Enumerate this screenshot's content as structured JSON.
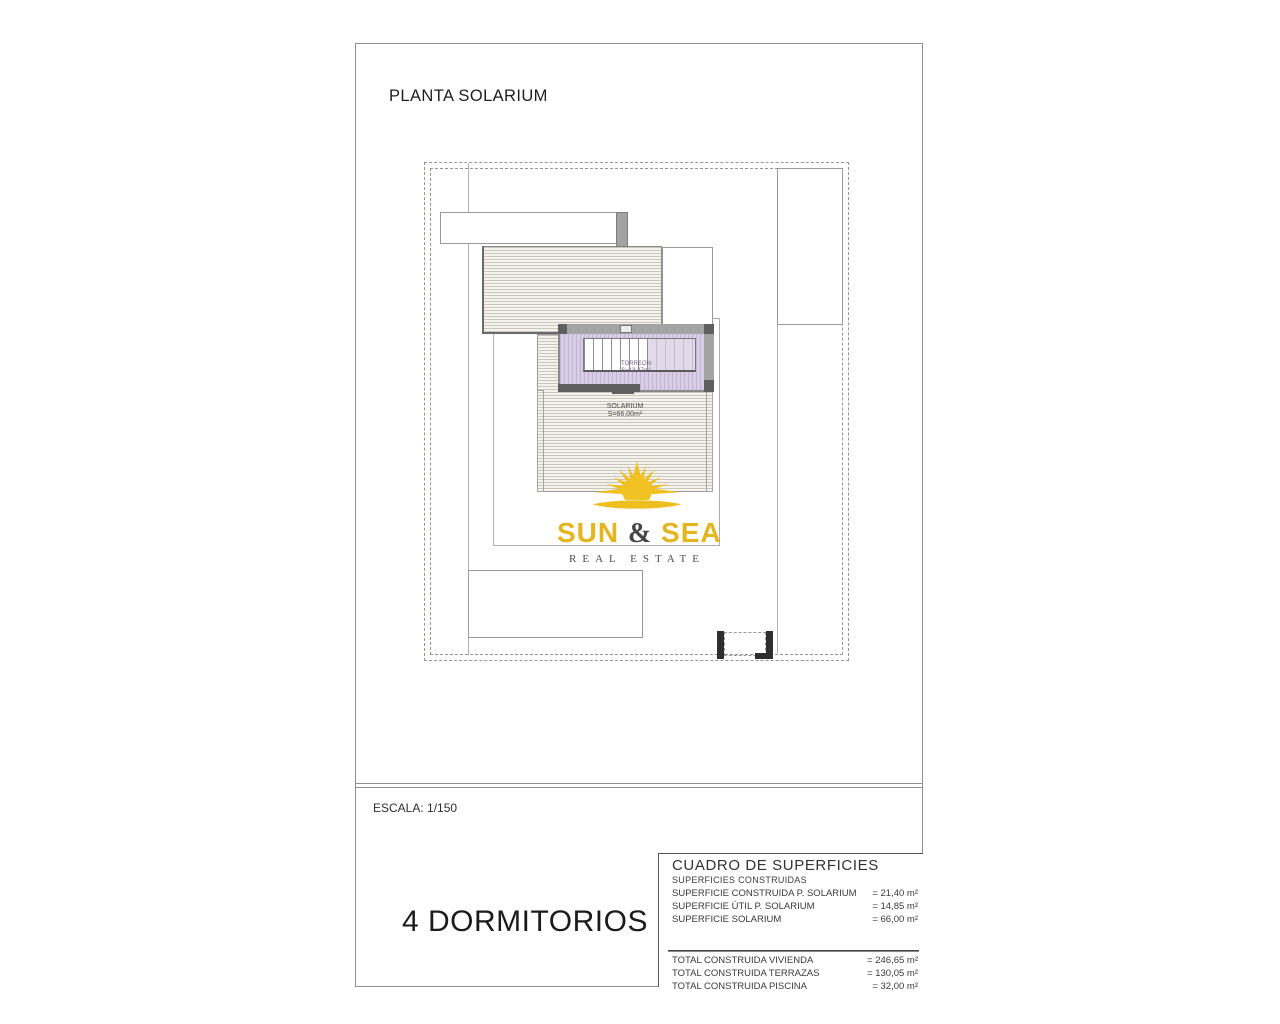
{
  "page": {
    "title": "PLANTA SOLARIUM",
    "scale_label": "ESCALA: 1/150",
    "bedrooms_label": "4 DORMITORIOS"
  },
  "plan": {
    "torreon_label": "TORREON",
    "torreon_area": "S=13,47m²",
    "solarium_label": "SOLARIUM",
    "solarium_area": "S=66,00m²"
  },
  "logo": {
    "word1": "SUN",
    "amp": "&",
    "word2": "SEA",
    "tagline": "REAL ESTATE"
  },
  "surface_table": {
    "title": "CUADRO DE SUPERFICIES",
    "subtitle": "SUPERFICIES CONSTRUIDAS",
    "rows": [
      {
        "label": "SUPERFICIE CONSTRUIDA P. SOLARIUM",
        "value": "= 21,40 m²"
      },
      {
        "label": "SUPERFICIE ÚTIL P. SOLARIUM",
        "value": "= 14,85 m²"
      },
      {
        "label": "SUPERFICIE SOLARIUM",
        "value": "= 66,00 m²"
      }
    ],
    "totals": [
      {
        "label": "TOTAL CONSTRUIDA VIVIENDA",
        "value": "= 246,65 m²"
      },
      {
        "label": "TOTAL CONSTRUIDA TERRAZAS",
        "value": "= 130,05 m²"
      },
      {
        "label": "TOTAL CONSTRUIDA PISCINA",
        "value": "= 32,00 m²"
      }
    ]
  },
  "colors": {
    "accent_gold": "#E3B51E",
    "dashed_boundary": "#A39191",
    "plan_line_gray": "#8F8F8F",
    "torreon_fill": "#D9CDE5",
    "dark_wall": "#5F5F5F",
    "text": "#333333"
  }
}
